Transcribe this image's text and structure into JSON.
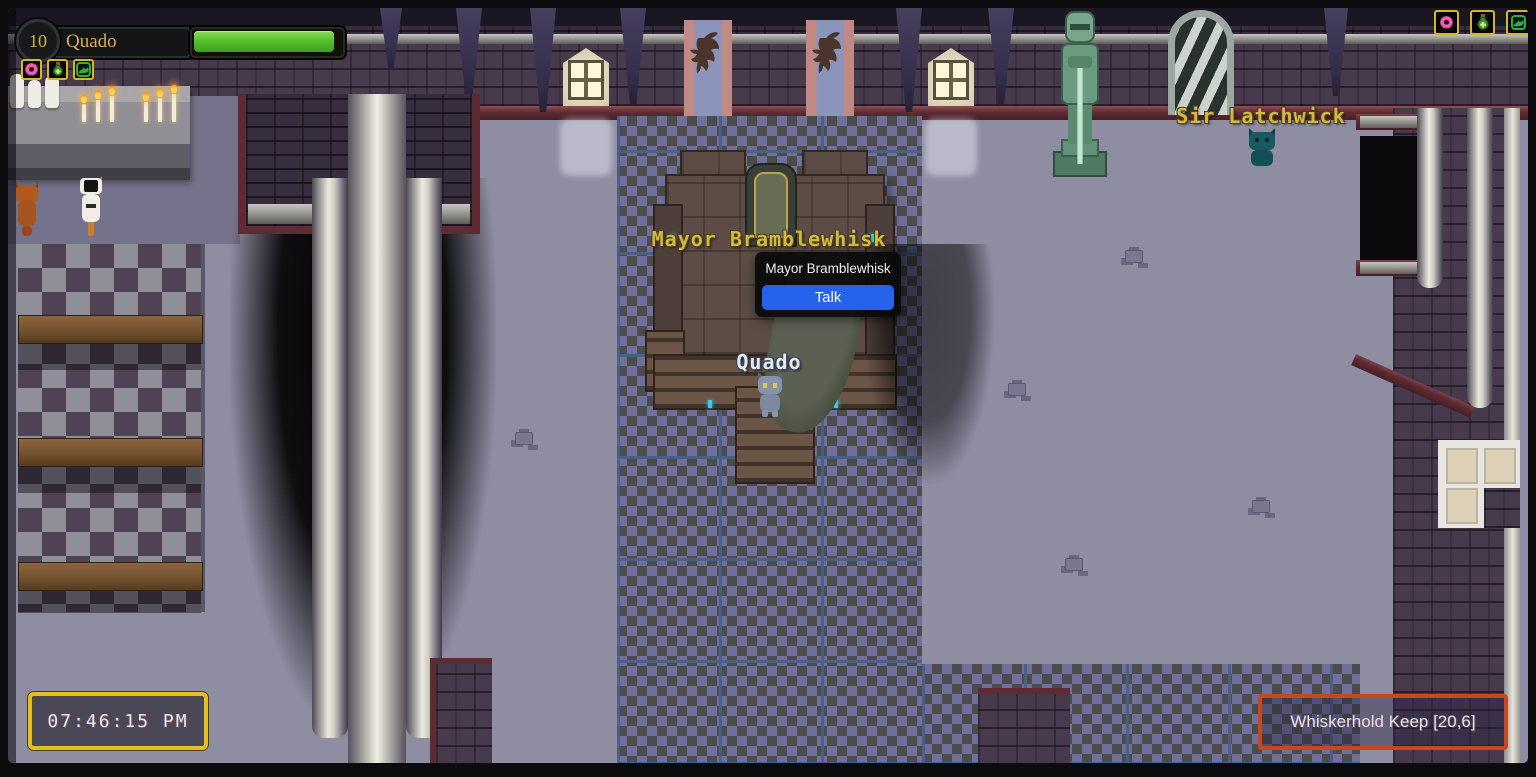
{
  "hud": {
    "level": "10",
    "player_name": "Quado",
    "hp_percent": 90
  },
  "quickbar": {
    "items": [
      {
        "icon": "donut-icon"
      },
      {
        "icon": "potion-icon"
      },
      {
        "icon": "cat-run-icon"
      }
    ]
  },
  "top_right_bar": {
    "items": [
      {
        "icon": "donut-icon"
      },
      {
        "icon": "potion-icon"
      },
      {
        "icon": "cat-run-icon"
      }
    ]
  },
  "world": {
    "npc_labels": [
      {
        "id": "mayor",
        "text": "Mayor Bramblewhisk"
      },
      {
        "id": "sir-latchwick",
        "text": "Sir Latchwick"
      }
    ],
    "player_label": {
      "text": "Quado"
    }
  },
  "context_menu": {
    "title": "Mayor Bramblewhisk",
    "actions": [
      {
        "label": "Talk"
      }
    ]
  },
  "clock": {
    "time": "07:46:15 PM"
  },
  "location_banner": {
    "text": "Whiskerhold Keep [20,6]"
  },
  "colors": {
    "hp_fill": "#57c22f",
    "accent_gold": "#d9b04a",
    "npc_label": "#d8b838",
    "player_label": "#e3eaf6",
    "talk_button": "#2563eb",
    "clock_border": "#e6be1e",
    "location_border": "#c8471f"
  }
}
